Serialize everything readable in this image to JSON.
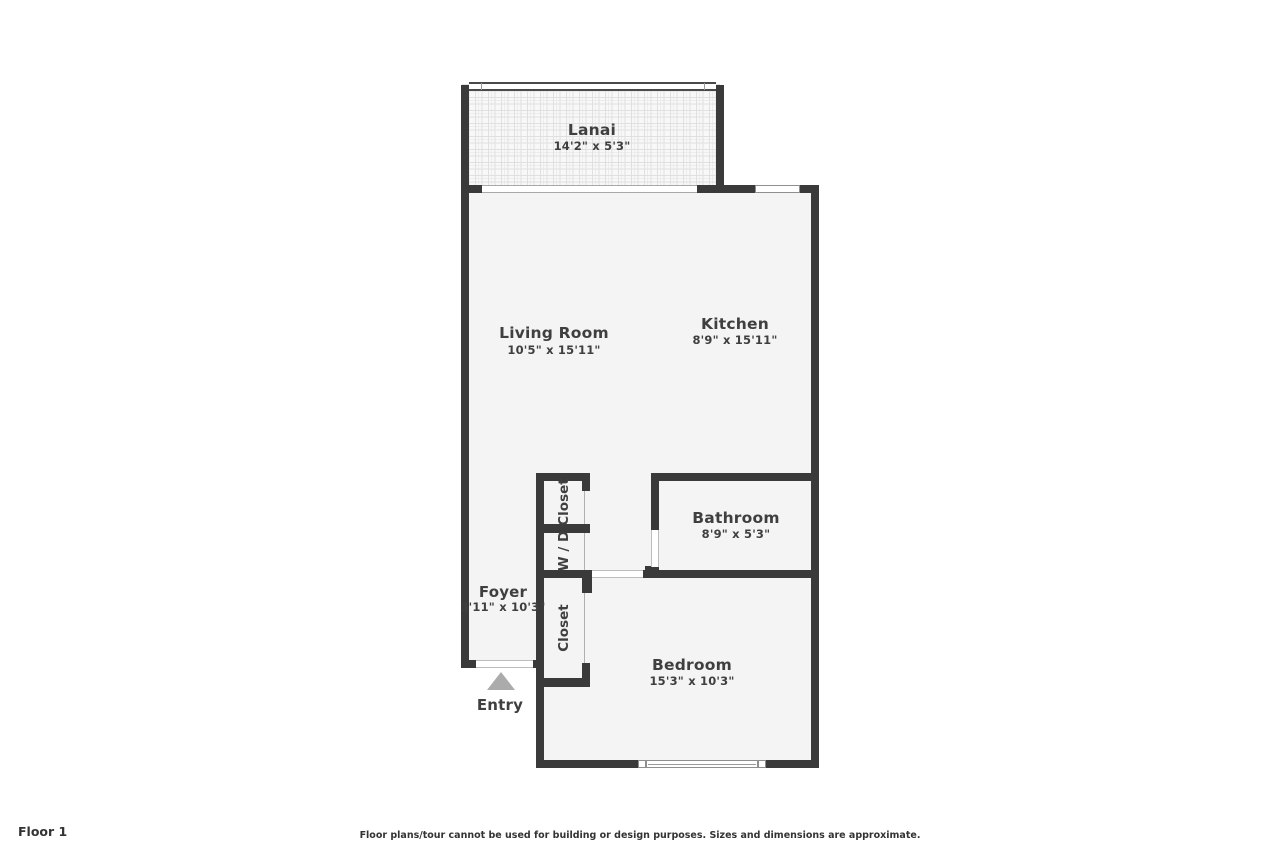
{
  "rooms": {
    "lanai": {
      "name": "Lanai",
      "dims": "14'2\" x 5'3\""
    },
    "living_room": {
      "name": "Living Room",
      "dims": "10'5\" x 15'11\""
    },
    "kitchen": {
      "name": "Kitchen",
      "dims": "8'9\" x 15'11\""
    },
    "bathroom": {
      "name": "Bathroom",
      "dims": "8'9\" x 5'3\""
    },
    "foyer": {
      "name": "Foyer",
      "dims": "3'11\" x 10'3\""
    },
    "bedroom": {
      "name": "Bedroom",
      "dims": "15'3\" x 10'3\""
    },
    "closet_top": {
      "name": "Closet"
    },
    "washer_dryer": {
      "name": "W / D"
    },
    "closet_bottom": {
      "name": "Closet"
    },
    "entry": {
      "name": "Entry"
    }
  },
  "footer": {
    "floor_label": "Floor 1",
    "disclaimer": "Floor plans/tour cannot be used for building or design purposes. Sizes and dimensions are approximate."
  },
  "colors": {
    "wall": "#3a3a3a",
    "floor": "#f4f4f4",
    "text": "#3f3f3f",
    "entry_arrow": "#ababab",
    "background": "#ffffff"
  }
}
